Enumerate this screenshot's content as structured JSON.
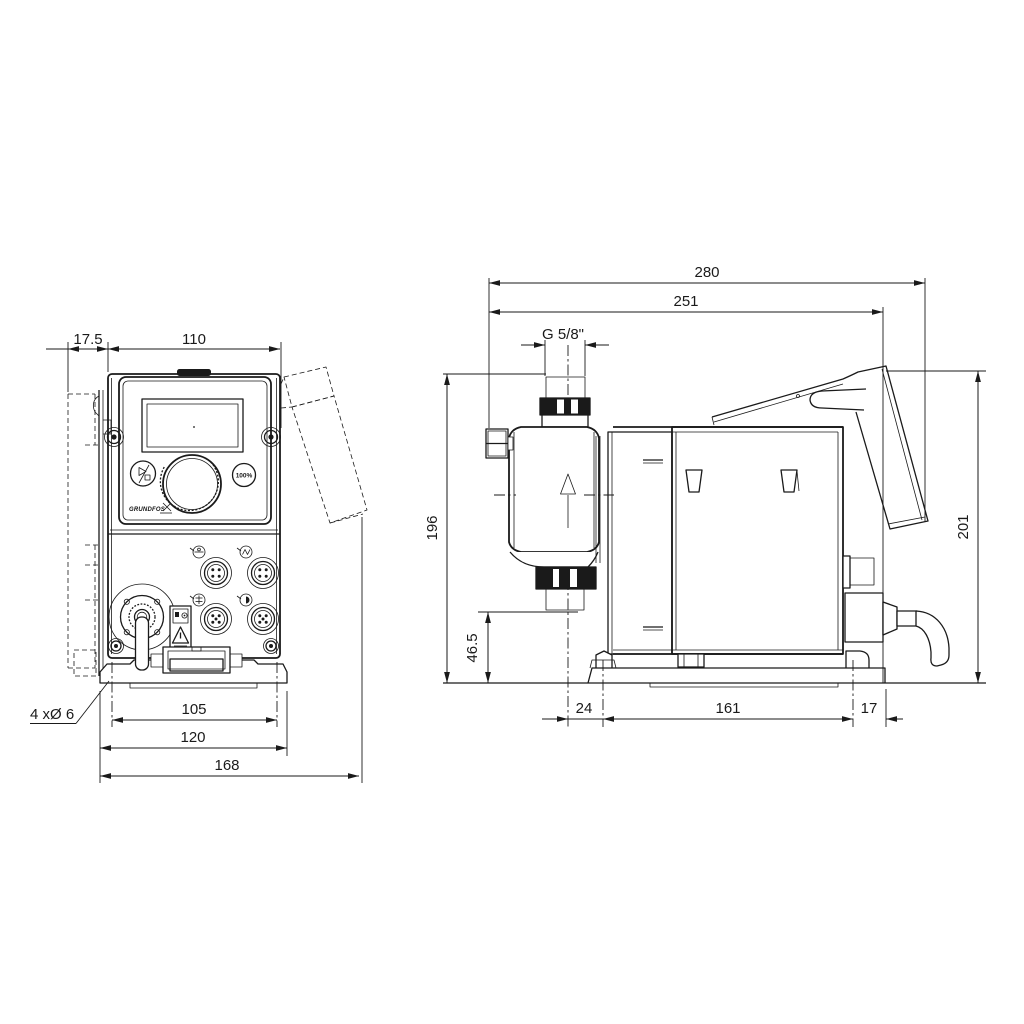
{
  "drawing_type": "pump-dimensional-drawing",
  "front": {
    "dim_offset": "17.5",
    "dim_width": "110",
    "dim_hole_spacing": "105",
    "dim_plate_width": "120",
    "dim_depth": "168",
    "label_mounting_holes": "4 xØ 6",
    "button_capacity": "100%",
    "brand": "GRUNDFOS"
  },
  "side": {
    "dim_overall_length": "280",
    "dim_length_to_flange": "251",
    "dim_thread": "G 5/8\"",
    "dim_height_to_valve_top": "196",
    "dim_valve_bottom_height": "46.5",
    "dim_base_offset": "24",
    "dim_hole_spacing": "161",
    "dim_base_edge": "17",
    "dim_overall_height": "201"
  },
  "colors": {
    "line": "#1a1a1a",
    "background": "#ffffff"
  }
}
